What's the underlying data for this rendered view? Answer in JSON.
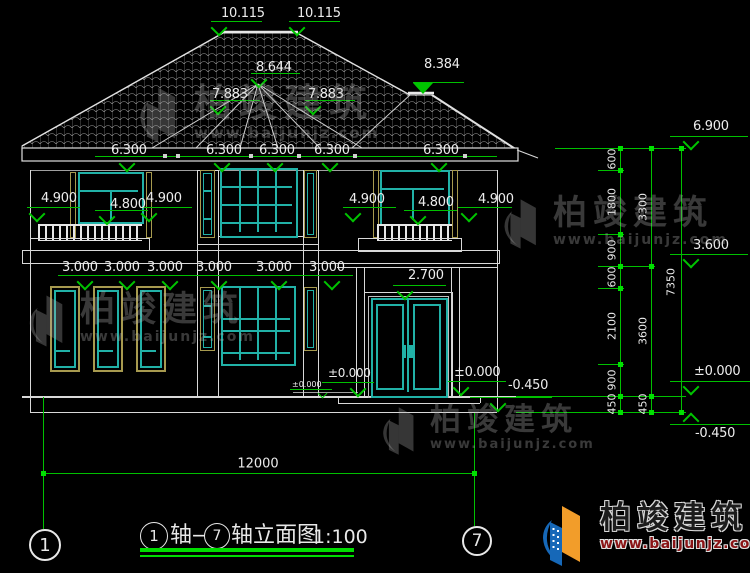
{
  "drawing": {
    "elevation_labels": {
      "ridge_left": "10.115",
      "ridge_right": "10.115",
      "turret_peak": "8.644",
      "turret_eave_left": "7.883",
      "turret_eave_right": "7.883",
      "wing_ridge": "8.384",
      "eave_row": [
        "6.300",
        "6.300",
        "6.300",
        "6.300",
        "6.300"
      ],
      "left_bay": [
        "4.900",
        "4.800",
        "4.900"
      ],
      "right_bay": [
        "4.900",
        "4.800",
        "4.900"
      ],
      "floor1_row": [
        "3.000",
        "3.000",
        "3.000",
        "3.000",
        "3.000",
        "3.000"
      ],
      "door_top": "2.700",
      "zero_left": "±0.000",
      "zero_small": "±0.000",
      "zero_right": "±0.000",
      "minus_mid": "-0.450"
    },
    "right_levels": {
      "top": "6.900",
      "mid": "3.600",
      "zero": "±0.000",
      "bottom": "-0.450"
    },
    "chain": {
      "inner": [
        "600",
        "1800",
        "900",
        "600",
        "2100",
        "900",
        "450"
      ],
      "mid": [
        "3300",
        "3600",
        "450"
      ],
      "total": "7350"
    },
    "bottom": {
      "width": "12000",
      "axis_left": "1",
      "axis_right": "7"
    },
    "title": {
      "axis_a": "1",
      "seg1": "轴—",
      "axis_b": "7",
      "seg2": "轴立面图",
      "scale": "1:100"
    }
  },
  "watermark": {
    "name": "柏竣建筑",
    "url": "www.baijunjz.com"
  },
  "brand": {
    "name": "柏竣建筑",
    "url": "www.baijunjz.com"
  },
  "colors": {
    "dimension_green": "#00c400",
    "bright_green": "#00dd00",
    "window_teal": "#21b1a7",
    "frame_tan": "#a79a4f",
    "line_white": "#d9d9d9",
    "brand_blue": "#1668b8",
    "brand_orange": "#f29d2a"
  }
}
